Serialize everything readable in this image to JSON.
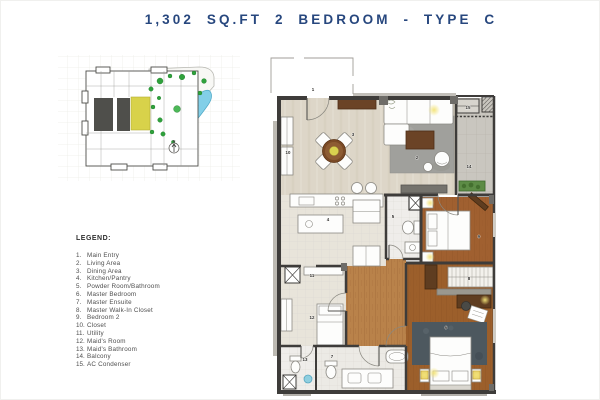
{
  "title": "1,302 SQ.FT 2 BEDROOM - TYPE C",
  "keyplan": {
    "pool_label": "Infinity Pool",
    "north_label": "N",
    "unit_highlight_color": "#d8d24a",
    "pool_color": "#82cfe8",
    "tree_color": "#2fa13c",
    "core_color": "#4f4f4b"
  },
  "legend": {
    "heading": "LEGEND:",
    "items": [
      {
        "n": "1.",
        "label": "Main Entry"
      },
      {
        "n": "2.",
        "label": "Living Area"
      },
      {
        "n": "3.",
        "label": "Dining Area"
      },
      {
        "n": "4.",
        "label": "Kitchen/Pantry"
      },
      {
        "n": "5.",
        "label": "Powder Room/Bathroom"
      },
      {
        "n": "6.",
        "label": "Master Bedroom"
      },
      {
        "n": "7.",
        "label": "Master Ensuite"
      },
      {
        "n": "8.",
        "label": "Master Walk-In Closet"
      },
      {
        "n": "9.",
        "label": "Bedroom 2"
      },
      {
        "n": "10.",
        "label": "Closet"
      },
      {
        "n": "11.",
        "label": "Utility"
      },
      {
        "n": "12.",
        "label": "Maid's Room"
      },
      {
        "n": "13.",
        "label": "Maid's Bathroom"
      },
      {
        "n": "14.",
        "label": "Balcony"
      },
      {
        "n": "15.",
        "label": "AC Condenser"
      }
    ]
  },
  "floorplan": {
    "room_numbers": [
      {
        "n": "1",
        "x": 312,
        "y": 90
      },
      {
        "n": "2",
        "x": 416,
        "y": 158
      },
      {
        "n": "3",
        "x": 352,
        "y": 135
      },
      {
        "n": "4",
        "x": 327,
        "y": 220
      },
      {
        "n": "5",
        "x": 392,
        "y": 217
      },
      {
        "n": "6",
        "x": 445,
        "y": 328
      },
      {
        "n": "7",
        "x": 331,
        "y": 357
      },
      {
        "n": "8",
        "x": 468,
        "y": 279
      },
      {
        "n": "9",
        "x": 478,
        "y": 237
      },
      {
        "n": "10",
        "x": 287,
        "y": 153
      },
      {
        "n": "11",
        "x": 311,
        "y": 276
      },
      {
        "n": "12",
        "x": 311,
        "y": 318
      },
      {
        "n": "13",
        "x": 304,
        "y": 360
      },
      {
        "n": "14",
        "x": 468,
        "y": 167
      },
      {
        "n": "15",
        "x": 467,
        "y": 108
      }
    ]
  },
  "colors": {
    "title_navy": "#27477e",
    "wall_dark": "#3e3c3a",
    "floor_beige": "#ddd6c8",
    "floor_wood": "#a06030",
    "floor_corridor_wood": "#b9824a",
    "balcony_gray": "#c9c6bf",
    "master_rug_dark": "#4d585f",
    "living_rug_gray": "#a0a09c",
    "lamp_yellow": "#e8d26a",
    "planter_green": "#5d8c46"
  }
}
